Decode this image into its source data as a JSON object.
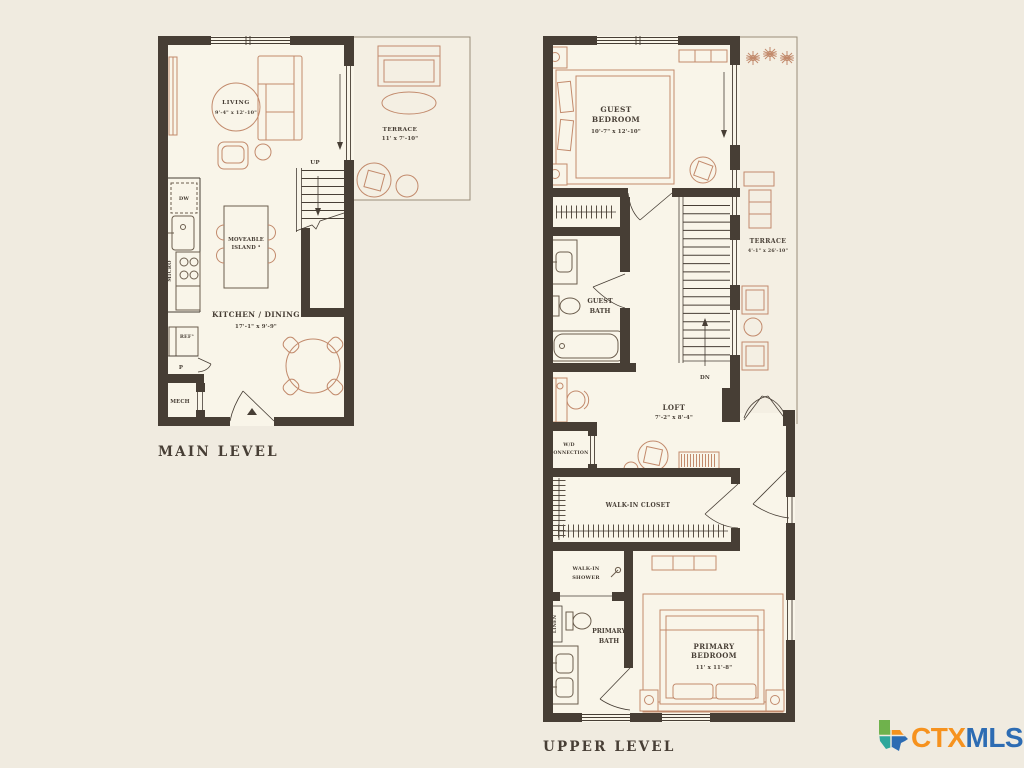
{
  "background": "#f0ebe0",
  "palette": {
    "wall": "#473e35",
    "floor": "#f9f5e9",
    "terrace_floor": "#f4efe3",
    "furniture": "#c28a6c",
    "fixture": "#6b5d4d",
    "label_text": "#473e35",
    "terrace_outline": "#9a8d7a",
    "logo_orange": "#f6921e",
    "logo_blue": "#2d6cb3",
    "logo_green": "#6fb24c",
    "logo_teal": "#2fa79b"
  },
  "main": {
    "title": "MAIN LEVEL",
    "living": "LIVING",
    "living_dim": "9'-4\" x 12'-10\"",
    "terrace": "TERRACE",
    "terrace_dim": "11' x 7'-10\"",
    "kitchen": "KITCHEN / DINING",
    "kitchen_dim": "17'-1\" x 9'-9\"",
    "island_1": "MOVEABLE",
    "island_2": "ISLAND ⁴",
    "up": "UP",
    "dw": "DW",
    "micro": "MICRO",
    "ref": "REF°",
    "pantry": "P",
    "mech": "MECH"
  },
  "upper": {
    "title": "UPPER LEVEL",
    "guest_bedroom_1": "GUEST",
    "guest_bedroom_2": "BEDROOM",
    "guest_bedroom_dim": "10'-7\" x 12'-10\"",
    "terrace": "TERRACE",
    "terrace_dim": "4'-1\" x 26'-10\"",
    "guest_bath_1": "GUEST",
    "guest_bath_2": "BATH",
    "dn": "DN",
    "loft": "LOFT",
    "loft_dim": "7'-2\" x 8'-4\"",
    "wd_1": "W/D",
    "wd_2": "CONNECTION",
    "walkin_closet": "WALK-IN CLOSET",
    "shower_1": "WALK-IN",
    "shower_2": "SHOWER",
    "linen": "LINEN",
    "primary_bath_1": "PRIMARY",
    "primary_bath_2": "BATH",
    "primary_bedroom_1": "PRIMARY",
    "primary_bedroom_2": "BEDROOM",
    "primary_bedroom_dim": "11' x 11'-8\""
  },
  "logo": {
    "ctx": "CTX",
    "mls": "MLS"
  }
}
